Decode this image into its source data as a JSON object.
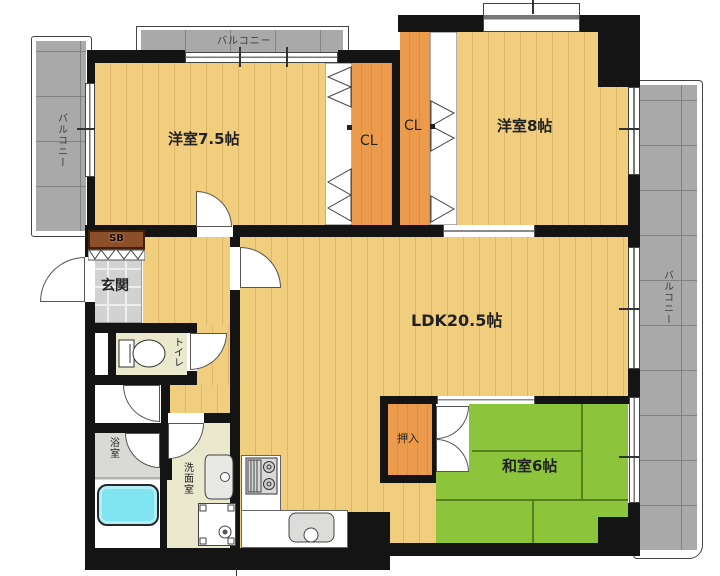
{
  "labels": {
    "balcony_left": "バルコニー",
    "balcony_top": "バルコニー",
    "balcony_right": "バルコニー",
    "western_room_75": "洋室7.5帖",
    "western_room_8": "洋室8帖",
    "closet_left": "CL",
    "closet_right": "CL",
    "ldk": "LDK20.5帖",
    "japanese_room": "和室6帖",
    "oshiire": "押入",
    "entrance": "玄関",
    "shoe_box": "SB",
    "toilet": "トイレ",
    "bathroom": "浴室",
    "washroom": "洗面室"
  },
  "colors": {
    "wall": "#141414",
    "wood_floor": "#f1cd7e",
    "closet_orange": "#eb9b4b",
    "tatami_green": "#8cc43c",
    "balcony_gray": "#a9a9a9",
    "entrance_tile": "#d2d2d2",
    "service_floor": "#eae8cd",
    "bathtub_cyan": "#7fe3f0",
    "shoe_box_brown": "#8d4f2a"
  }
}
